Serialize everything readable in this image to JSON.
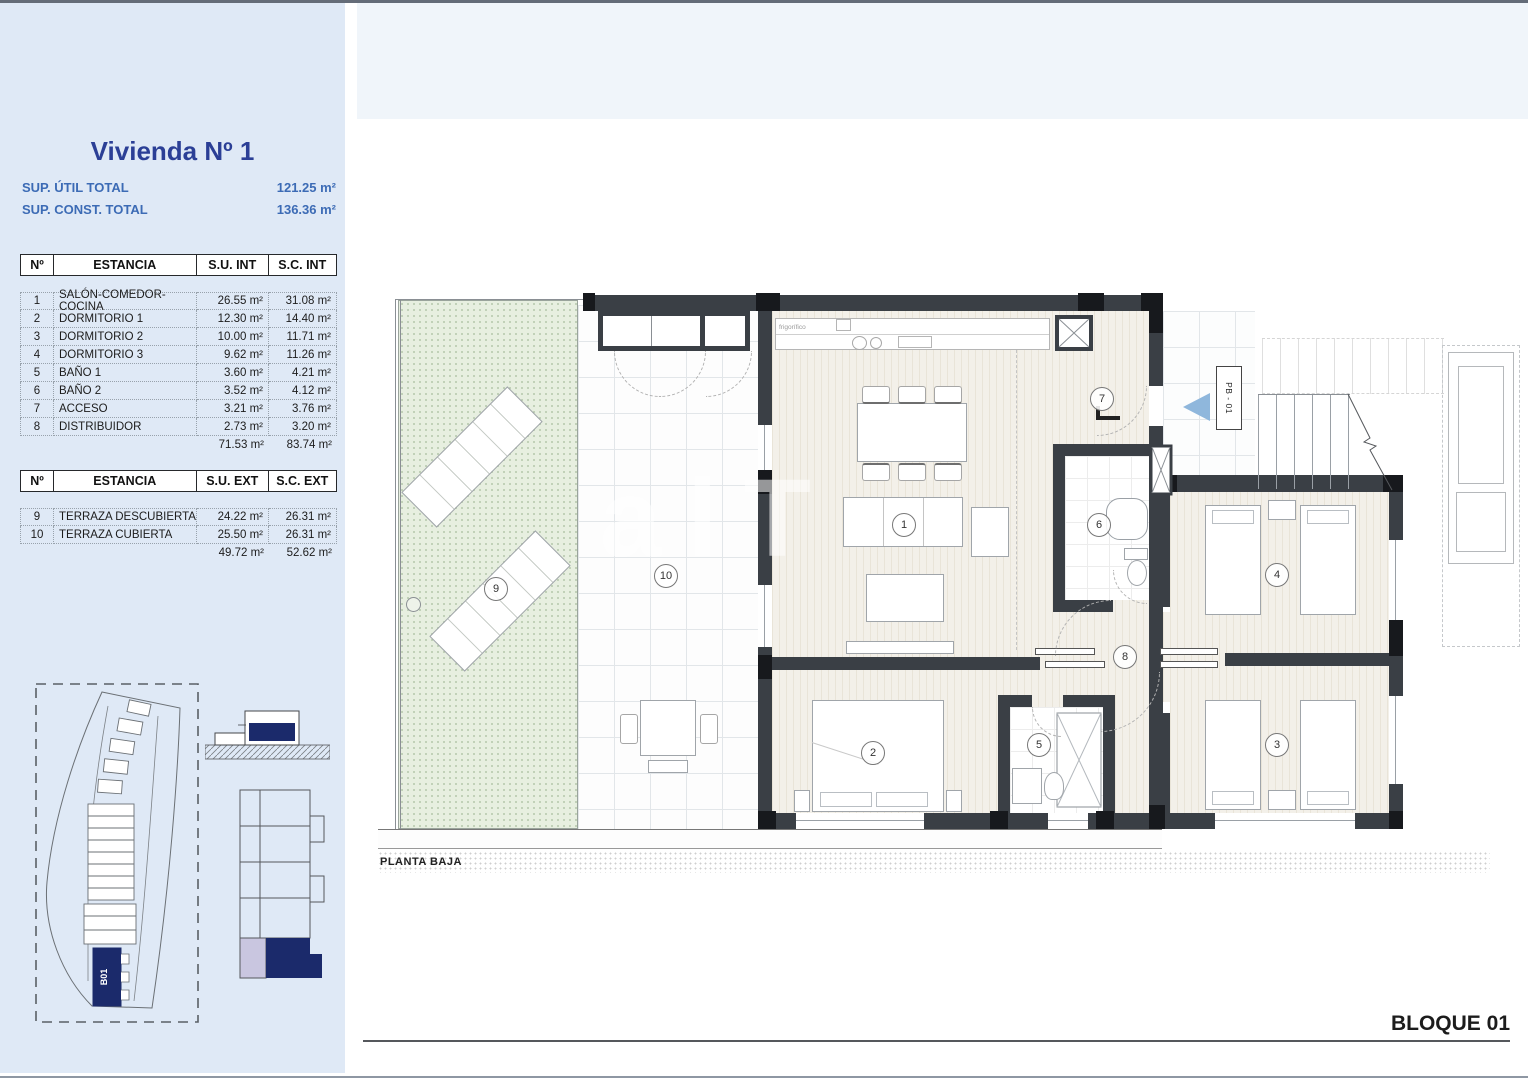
{
  "sidebar": {
    "title": "Vivienda Nº 1",
    "totals": [
      {
        "label": "SUP. ÚTIL TOTAL",
        "value": "121.25 m²"
      },
      {
        "label": "SUP. CONST. TOTAL",
        "value": "136.36 m²"
      }
    ]
  },
  "t1": {
    "headers": [
      "Nº",
      "ESTANCIA",
      "S.U. INT",
      "S.C. INT"
    ],
    "rows": [
      [
        "1",
        "SALÓN-COMEDOR-COCINA",
        "26.55 m²",
        "31.08 m²"
      ],
      [
        "2",
        "DORMITORIO 1",
        "12.30 m²",
        "14.40 m²"
      ],
      [
        "3",
        "DORMITORIO 2",
        "10.00 m²",
        "11.71 m²"
      ],
      [
        "4",
        "DORMITORIO 3",
        "9.62 m²",
        "11.26 m²"
      ],
      [
        "5",
        "BAÑO 1",
        "3.60 m²",
        "4.21 m²"
      ],
      [
        "6",
        "BAÑO 2",
        "3.52 m²",
        "4.12 m²"
      ],
      [
        "7",
        "ACCESO",
        "3.21 m²",
        "3.76 m²"
      ],
      [
        "8",
        "DISTRIBUIDOR",
        "2.73 m²",
        "3.20 m²"
      ]
    ],
    "total": [
      "71.53 m²",
      "83.74 m²"
    ]
  },
  "t2": {
    "headers": [
      "Nº",
      "ESTANCIA",
      "S.U. EXT",
      "S.C. EXT"
    ],
    "rows": [
      [
        "9",
        "TERRAZA DESCUBIERTA",
        "24.22 m²",
        "26.31 m²"
      ],
      [
        "10",
        "TERRAZA CUBIERTA",
        "25.50 m²",
        "26.31 m²"
      ]
    ],
    "total": [
      "49.72 m²",
      "52.62 m²"
    ]
  },
  "site": {
    "block": "B01"
  },
  "plan": {
    "floor_label": "PLANTA BAJA",
    "block_label": "BLOQUE 01",
    "entry_tag": "PB - 01",
    "fridge": "frigorífico",
    "watermark": "alT",
    "rooms": {
      "r1": "1",
      "r2": "2",
      "r3": "3",
      "r4": "4",
      "r5": "5",
      "r6": "6",
      "r7": "7",
      "r8": "8",
      "r9": "9",
      "r10": "10"
    }
  },
  "colors": {
    "panel_blue": "#dfe9f6",
    "band_blue": "#f0f5fa",
    "title_navy": "#2b3f96",
    "label_blue": "#3c6bb5",
    "block_navy": "#1b2a6b",
    "lavender": "#c9c6e0",
    "entry_triangle": "#8fb7dc",
    "wall": "#3a3f45"
  }
}
